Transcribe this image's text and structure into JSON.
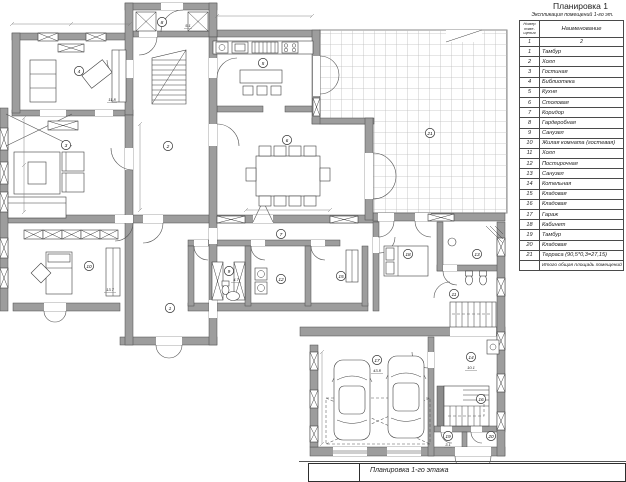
{
  "page": {
    "top_title": "Планировка 1",
    "bottom_title": "Планировка 1-го этажа"
  },
  "table": {
    "subtitle": "Экспликация помещений 1-го эт.",
    "col1_header": "Номер поме- щения",
    "col2_header": "Наименование",
    "subheader": [
      "1",
      "2"
    ],
    "rows": [
      {
        "num": "1",
        "name": "Тамбур"
      },
      {
        "num": "2",
        "name": "Холл"
      },
      {
        "num": "3",
        "name": "Гостиная"
      },
      {
        "num": "4",
        "name": "Библиотека"
      },
      {
        "num": "5",
        "name": "Кухня"
      },
      {
        "num": "6",
        "name": "Столовая"
      },
      {
        "num": "7",
        "name": "Коридор"
      },
      {
        "num": "8",
        "name": "Гардеробная"
      },
      {
        "num": "9",
        "name": "Санузел"
      },
      {
        "num": "10",
        "name": "Жилая комната (гостевая)"
      },
      {
        "num": "11",
        "name": "Холл"
      },
      {
        "num": "12",
        "name": "Постирочная"
      },
      {
        "num": "13",
        "name": "Санузел"
      },
      {
        "num": "14",
        "name": "Котельная"
      },
      {
        "num": "15",
        "name": "Кладовая"
      },
      {
        "num": "16",
        "name": "Кладовая"
      },
      {
        "num": "17",
        "name": "Гараж"
      },
      {
        "num": "18",
        "name": "Кабинет"
      },
      {
        "num": "19",
        "name": "Тамбур"
      },
      {
        "num": "20",
        "name": "Кладовая"
      },
      {
        "num": "21",
        "name": "Терраса (90,5*0,3=27,15)"
      }
    ],
    "footer": "Итого общая площадь помещений"
  },
  "plan": {
    "rooms": [
      {
        "num": "1"
      },
      {
        "num": "2"
      },
      {
        "num": "3"
      },
      {
        "num": "4"
      },
      {
        "num": "5"
      },
      {
        "num": "6"
      },
      {
        "num": "7"
      },
      {
        "num": "8"
      },
      {
        "num": "9"
      },
      {
        "num": "10"
      },
      {
        "num": "11"
      },
      {
        "num": "12"
      },
      {
        "num": "13"
      },
      {
        "num": "14"
      },
      {
        "num": "15"
      },
      {
        "num": "16"
      },
      {
        "num": "17"
      },
      {
        "num": "18"
      },
      {
        "num": "19"
      },
      {
        "num": "20"
      },
      {
        "num": "21"
      }
    ],
    "areas": [
      {
        "v": "11.8"
      },
      {
        "v": "5.1"
      },
      {
        "v": "13.7"
      },
      {
        "v": "4.7"
      },
      {
        "v": "43.8"
      },
      {
        "v": "10.1"
      },
      {
        "v": "3.1"
      }
    ],
    "colors": {
      "wall": "#9d9d9d",
      "line": "#3f3f3f",
      "grid": "#bcbcbc"
    }
  }
}
